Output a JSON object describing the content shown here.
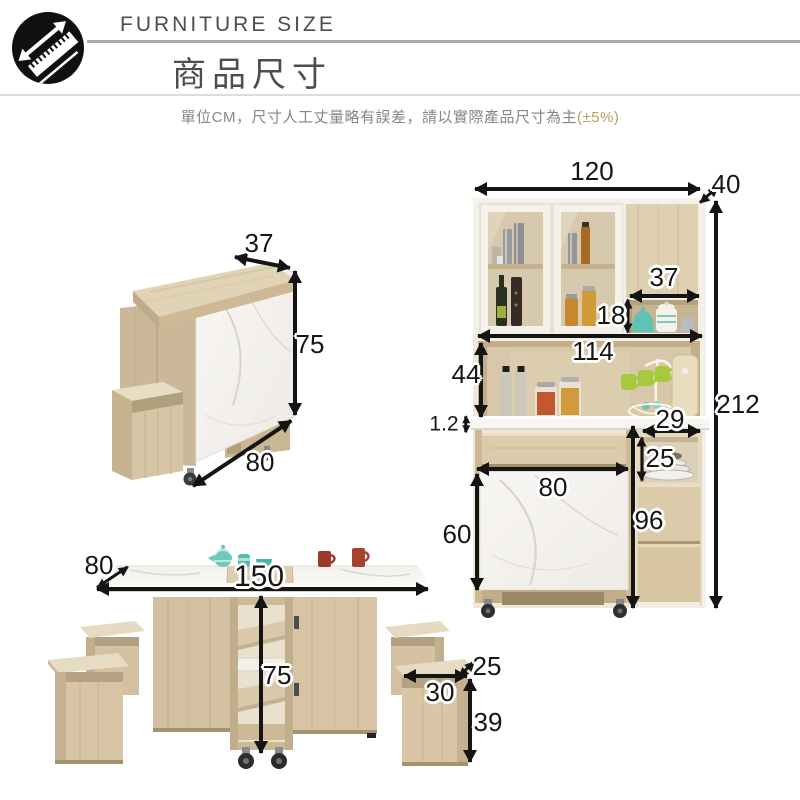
{
  "header": {
    "brand": "FURNITURE SIZE",
    "title": "商品尺寸"
  },
  "note": {
    "text": "單位CM，尺寸人工丈量略有誤差，請以實際產品尺寸為主",
    "tolerance": "(±5%)"
  },
  "icons": {
    "badge": "diagonal-ruler-arrow-icon"
  },
  "dimensions": {
    "unit_note": "CM",
    "folded_table": {
      "top_depth": "37",
      "height": "75",
      "length": "80"
    },
    "cabinet": {
      "width": "120",
      "depth": "40",
      "total_height": "212",
      "niche_width": "37",
      "niche_height": "18",
      "inner_width": "114",
      "opening_height": "44",
      "counter_thickness": "1.2",
      "fold_door_width": "80",
      "fold_door_height": "60",
      "side_unit_height": "96",
      "side_shelf_width": "29",
      "side_shelf_height": "25"
    },
    "extended_table": {
      "depth": "80",
      "length": "150",
      "height": "75"
    },
    "stool": {
      "depth": "25",
      "width": "30",
      "height": "39"
    }
  },
  "colors": {
    "accent": "#bf9a5f",
    "rule": "#acacac",
    "divider": "#dcdcdc",
    "arrow": "#141414",
    "wood_light": "#e3d5ba",
    "wood_mid": "#d5c3a3",
    "wood_dark": "#b9a685",
    "marble": "#f6f4f0"
  }
}
